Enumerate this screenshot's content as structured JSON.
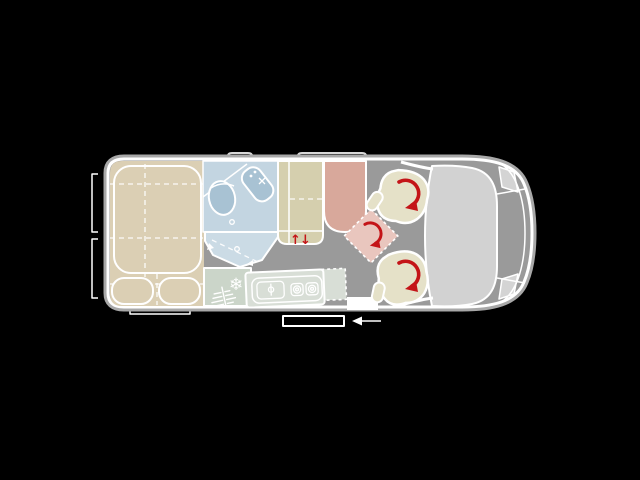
{
  "title": "Campervan floor plan (top view)",
  "floorplan": {
    "vehicle": "campervan-top-view",
    "cab_position": "right",
    "travel_arrow_direction": "left",
    "swivel_arrow_count": 3,
    "features": [
      "rear-bed",
      "bathroom-with-shower",
      "wardrobe-cabinet",
      "fridge",
      "kitchen-block",
      "bench-seat",
      "swivel-table",
      "swivel-seat",
      "swivel-seat",
      "cab-bonnet"
    ]
  },
  "icons": {
    "snowflake": "❄",
    "lift_arrow_up": "↑",
    "lift_arrow_down": "↓"
  },
  "colors": {
    "background": "#000000",
    "floor": "#9a9a9a",
    "shell": "#a8a8a8",
    "outline": "#ffffff",
    "marker": "#d8d8d8",
    "bed": "#dbcfb4",
    "bathroom": "#c3d5e1",
    "shower": "#cbdbe5",
    "fixture": "#a8c2d3",
    "cabinet": "#d5cfae",
    "fridge": "#cbd5c9",
    "kitchen": "#d8ded6",
    "bench": "#d8a89b",
    "table": "#e9c6be",
    "seat": "#e5e1c8",
    "cab": "#d2d2d2",
    "headlight": "#d4d4d4",
    "accent": "#c41418"
  }
}
